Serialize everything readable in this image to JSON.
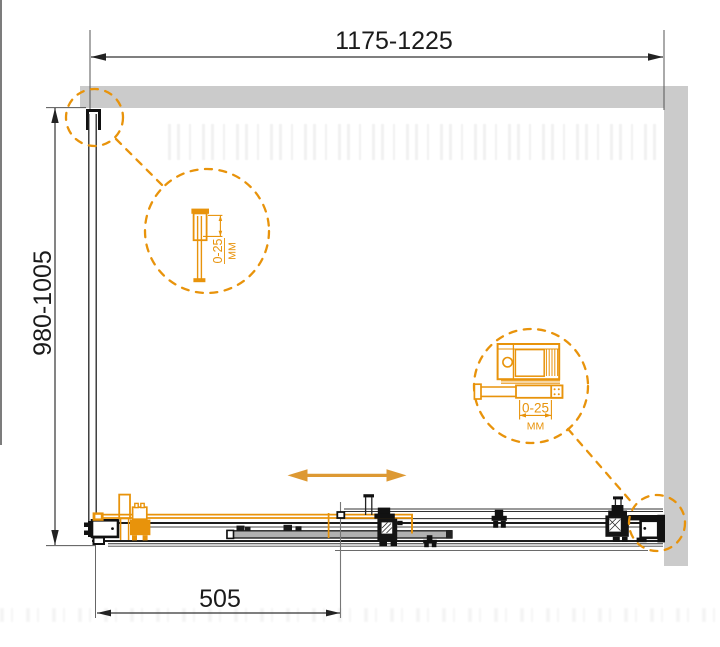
{
  "drawing": {
    "width_range_mm": "1175-1225",
    "height_range_mm": "980-1005",
    "door_opening_mm": "505",
    "detail_top": {
      "adjustment_range": "0-25",
      "unit": "ММ"
    },
    "detail_bottom": {
      "adjustment_range": "0-25",
      "unit": "ММ"
    }
  },
  "colors": {
    "accent_orange": "#E8930B",
    "arrow_orange": "#DD9933",
    "wall_gray": "#CBCBCB",
    "line_black": "#1C1C1C",
    "dim_line": "#3C3C3C"
  }
}
